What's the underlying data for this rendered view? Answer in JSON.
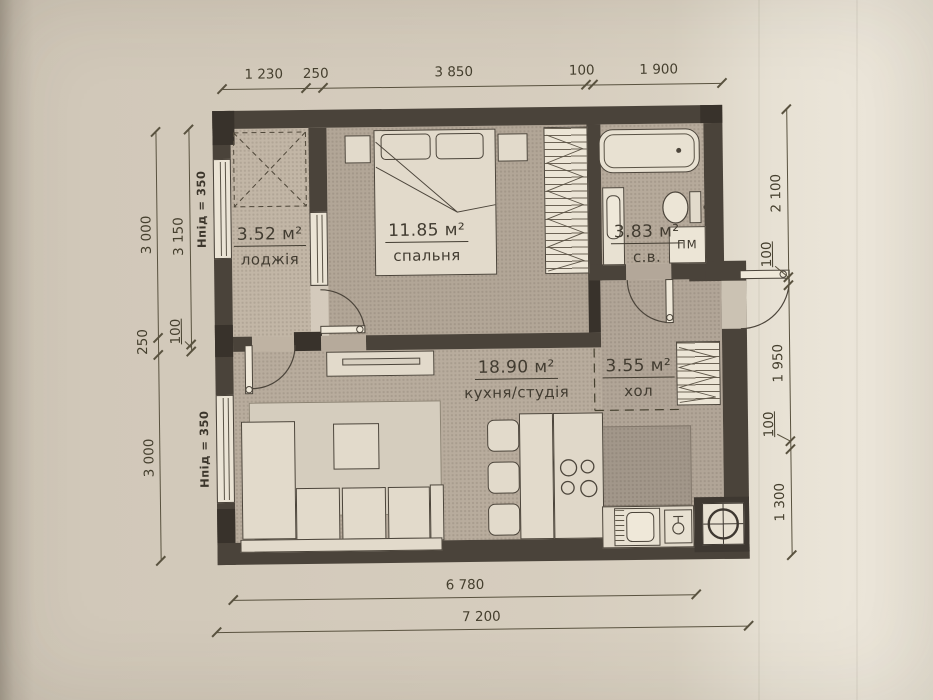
{
  "plan": {
    "rooms": [
      {
        "area": "3.52 м²",
        "name": "лоджія"
      },
      {
        "area": "11.85 м²",
        "name": "спальня"
      },
      {
        "area": "3.83 м²",
        "name": "с.в."
      },
      {
        "area": "18.90 м²",
        "name": "кухня/студія"
      },
      {
        "area": "3.55 м²",
        "name": "хол"
      }
    ],
    "labels": {
      "washing_machine": "ПМ",
      "sill_top": "Нпід = 350",
      "sill_bottom": "Нпід = 350"
    },
    "dimensions": {
      "top": [
        "1 230",
        "250",
        "3 850",
        "100",
        "1 900"
      ],
      "left_outer": [
        "3 000",
        "250",
        "3 000"
      ],
      "left_inner": [
        "3 150",
        "100"
      ],
      "right": [
        "2 100",
        "100",
        "1 950",
        "100",
        "1 300"
      ],
      "bottom": [
        "6 780",
        "7 200"
      ]
    },
    "colors": {
      "wall": "#4a433a",
      "floor": "#b7ab9c",
      "paper": "#d6cdbe",
      "furniture": "#e2dacb"
    }
  }
}
